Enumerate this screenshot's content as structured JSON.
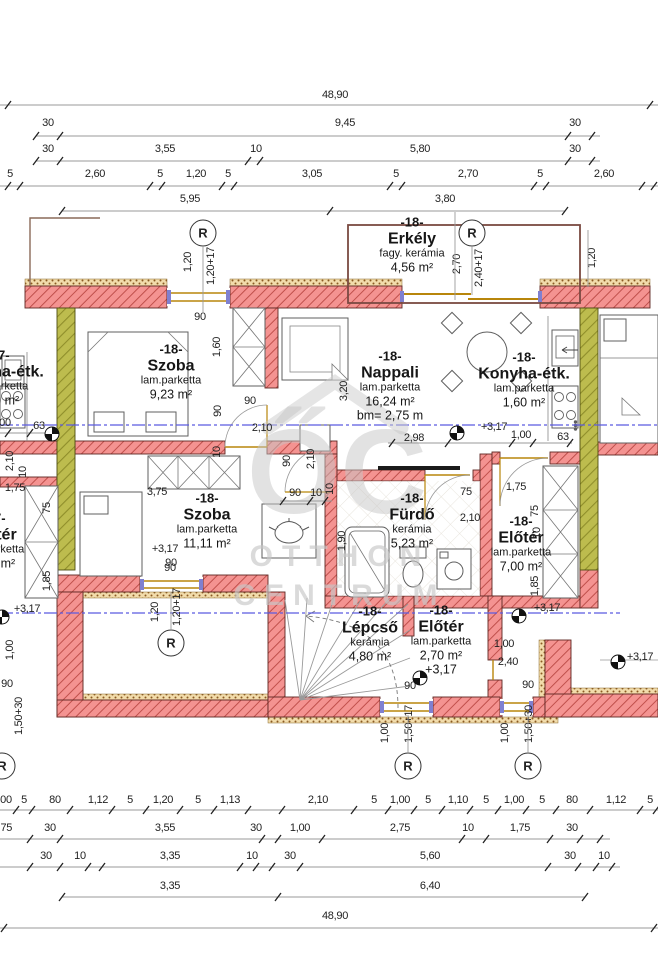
{
  "watermark": {
    "brand_initials": "ŐC",
    "line1": "OTTHON",
    "line2": "CENTRUM"
  },
  "markers": {
    "r_label": "R",
    "r_circles": [
      {
        "x": 203,
        "y": 233
      },
      {
        "x": 472,
        "y": 233
      },
      {
        "x": 171,
        "y": 643
      },
      {
        "x": 408,
        "y": 766
      },
      {
        "x": 528,
        "y": 766
      },
      {
        "x": 2,
        "y": 766
      }
    ],
    "level_markers": [
      {
        "x": 52,
        "y": 434
      },
      {
        "x": 457,
        "y": 433
      },
      {
        "x": 519,
        "y": 616
      },
      {
        "x": 420,
        "y": 678
      },
      {
        "x": 618,
        "y": 662
      },
      {
        "x": 2,
        "y": 617
      }
    ]
  },
  "colors": {
    "wall": "#f49391",
    "wall_hatch": "#c0504c",
    "insulation": "#f2dcab",
    "party_wall": "#bdbc4e",
    "window": "#b8860b",
    "glazing": "#8080d0",
    "section_line": "#5b5be0",
    "watermark": "#c7c7c7"
  },
  "rooms": [
    {
      "x": -2,
      "y": 378,
      "id": "-17-",
      "name": "Konyha-étk.",
      "material": "lam.parketta",
      "area": "1,60 m²"
    },
    {
      "x": 412,
      "y": 245,
      "id": "-18-",
      "name": "Erkély",
      "material": "fagy. kerámia",
      "area": "4,56 m²"
    },
    {
      "x": 171,
      "y": 372,
      "id": "-18-",
      "name": "Szoba",
      "material": "lam.parketta",
      "area": "9,23 m²"
    },
    {
      "x": 390,
      "y": 386,
      "id": "-18-",
      "name": "Nappali",
      "material": "lam.parketta",
      "area": "16,24 m²",
      "extra": "bm= 2,75 m"
    },
    {
      "x": 524,
      "y": 380,
      "id": "-18-",
      "name": "Konyha-étk.",
      "material": "lam.parketta",
      "area": "1,60 m²"
    },
    {
      "x": 207,
      "y": 521,
      "id": "-18-",
      "name": "Szoba",
      "material": "lam.parketta",
      "area": "11,11 m²"
    },
    {
      "x": 412,
      "y": 521,
      "id": "-18-",
      "name": "Fürdő",
      "material": "kerámia",
      "area": "5,23 m²"
    },
    {
      "x": 521,
      "y": 544,
      "id": "-18-",
      "name": "Előtér",
      "material": "lam.parketta",
      "area": "7,00 m²"
    },
    {
      "x": 370,
      "y": 634,
      "id": "-18-",
      "name": "Lépcső",
      "material": "kerámia",
      "area": "4,80 m²"
    },
    {
      "x": 441,
      "y": 640,
      "id": "-18-",
      "name": "Előtér",
      "material": "lam.parketta",
      "area": "2,70 m²",
      "extra": "+3,17"
    },
    {
      "x": -6,
      "y": 541,
      "id": "-17-",
      "name": "Előtér",
      "material": "lam.parketta",
      "area": "7,00 m²"
    }
  ],
  "dims": [
    {
      "t": "48,90",
      "x": 335,
      "y": 95
    },
    {
      "t": "30",
      "x": 48,
      "y": 123
    },
    {
      "t": "9,45",
      "x": 345,
      "y": 123
    },
    {
      "t": "30",
      "x": 575,
      "y": 123
    },
    {
      "t": "30",
      "x": 48,
      "y": 149
    },
    {
      "t": "3,55",
      "x": 165,
      "y": 149
    },
    {
      "t": "10",
      "x": 256,
      "y": 149
    },
    {
      "t": "5,80",
      "x": 420,
      "y": 149
    },
    {
      "t": "30",
      "x": 575,
      "y": 149
    },
    {
      "t": "5",
      "x": 10,
      "y": 174
    },
    {
      "t": "2,60",
      "x": 95,
      "y": 174
    },
    {
      "t": "5",
      "x": 160,
      "y": 174
    },
    {
      "t": "1,20",
      "x": 196,
      "y": 174
    },
    {
      "t": "5",
      "x": 228,
      "y": 174
    },
    {
      "t": "3,05",
      "x": 312,
      "y": 174
    },
    {
      "t": "5",
      "x": 396,
      "y": 174
    },
    {
      "t": "2,70",
      "x": 468,
      "y": 174
    },
    {
      "t": "5",
      "x": 540,
      "y": 174
    },
    {
      "t": "2,60",
      "x": 604,
      "y": 174
    },
    {
      "t": "5,95",
      "x": 190,
      "y": 199
    },
    {
      "t": "3,80",
      "x": 445,
      "y": 199
    },
    {
      "t": "1,20",
      "x": 188,
      "y": 262,
      "v": 1
    },
    {
      "t": "1,20+17",
      "x": 211,
      "y": 266,
      "v": 1
    },
    {
      "t": "90",
      "x": 200,
      "y": 317
    },
    {
      "t": "2,70",
      "x": 457,
      "y": 264,
      "v": 1
    },
    {
      "t": "2,40+17",
      "x": 479,
      "y": 268,
      "v": 1
    },
    {
      "t": "1,20",
      "x": 592,
      "y": 258,
      "v": 1
    },
    {
      "t": "1,60",
      "x": 217,
      "y": 347,
      "v": 1
    },
    {
      "t": "90",
      "x": 218,
      "y": 411,
      "v": 1
    },
    {
      "t": "90",
      "x": 250,
      "y": 401
    },
    {
      "t": "2,10",
      "x": 262,
      "y": 428
    },
    {
      "t": "10",
      "x": 217,
      "y": 452,
      "v": 1
    },
    {
      "t": "3,20",
      "x": 344,
      "y": 391,
      "v": 1
    },
    {
      "t": "2,98",
      "x": 414,
      "y": 438
    },
    {
      "t": "+3,17",
      "x": 494,
      "y": 427
    },
    {
      "t": "1,00",
      "x": 521,
      "y": 435
    },
    {
      "t": "63",
      "x": 563,
      "y": 437
    },
    {
      "t": "00",
      "x": 5,
      "y": 423
    },
    {
      "t": "63",
      "x": 39,
      "y": 426
    },
    {
      "t": "2,10",
      "x": 10,
      "y": 461,
      "v": 1
    },
    {
      "t": "10",
      "x": 23,
      "y": 472,
      "v": 1
    },
    {
      "t": "1,75",
      "x": 15,
      "y": 488
    },
    {
      "t": "75",
      "x": 47,
      "y": 508,
      "v": 1
    },
    {
      "t": "1,85",
      "x": 47,
      "y": 581,
      "v": 1
    },
    {
      "t": "3,75",
      "x": 157,
      "y": 492
    },
    {
      "t": "+3,17",
      "x": 165,
      "y": 549
    },
    {
      "t": "90",
      "x": 171,
      "y": 563
    },
    {
      "t": "90",
      "x": 295,
      "y": 493
    },
    {
      "t": "10",
      "x": 316,
      "y": 493
    },
    {
      "t": "90",
      "x": 287,
      "y": 461,
      "v": 1
    },
    {
      "t": "2,10",
      "x": 311,
      "y": 459,
      "v": 1
    },
    {
      "t": "10",
      "x": 330,
      "y": 489,
      "v": 1
    },
    {
      "t": "1,90",
      "x": 342,
      "y": 541,
      "v": 1
    },
    {
      "t": "75",
      "x": 466,
      "y": 492
    },
    {
      "t": "1,75",
      "x": 516,
      "y": 487
    },
    {
      "t": "2,10",
      "x": 470,
      "y": 518
    },
    {
      "t": "75",
      "x": 535,
      "y": 511,
      "v": 1
    },
    {
      "t": "1,85",
      "x": 535,
      "y": 586,
      "v": 1
    },
    {
      "t": "10",
      "x": 537,
      "y": 533,
      "v": 1
    },
    {
      "t": "1,00",
      "x": 504,
      "y": 644
    },
    {
      "t": "2,40",
      "x": 508,
      "y": 662
    },
    {
      "t": "90",
      "x": 410,
      "y": 686
    },
    {
      "t": "90",
      "x": 528,
      "y": 685
    },
    {
      "t": "90",
      "x": 170,
      "y": 568
    },
    {
      "t": "1,20",
      "x": 155,
      "y": 612,
      "v": 1
    },
    {
      "t": "1,20+17",
      "x": 177,
      "y": 607,
      "v": 1
    },
    {
      "t": "+3,17",
      "x": 27,
      "y": 609
    },
    {
      "t": "1,00",
      "x": 10,
      "y": 650,
      "v": 1
    },
    {
      "t": "90",
      "x": 7,
      "y": 684
    },
    {
      "t": "1,50+30",
      "x": 19,
      "y": 716,
      "v": 1
    },
    {
      "t": "1,00",
      "x": 385,
      "y": 733,
      "v": 1
    },
    {
      "t": "1,50+17",
      "x": 409,
      "y": 724,
      "v": 1
    },
    {
      "t": "1,00",
      "x": 505,
      "y": 733,
      "v": 1
    },
    {
      "t": "1,50+30",
      "x": 529,
      "y": 724,
      "v": 1
    },
    {
      "t": "+3,17",
      "x": 547,
      "y": 608
    },
    {
      "t": "+3,17",
      "x": 640,
      "y": 657
    },
    {
      "t": "00",
      "x": 6,
      "y": 800
    },
    {
      "t": "5",
      "x": 24,
      "y": 800
    },
    {
      "t": "80",
      "x": 55,
      "y": 800
    },
    {
      "t": "1,12",
      "x": 98,
      "y": 800
    },
    {
      "t": "5",
      "x": 130,
      "y": 800
    },
    {
      "t": "1,20",
      "x": 163,
      "y": 800
    },
    {
      "t": "5",
      "x": 198,
      "y": 800
    },
    {
      "t": "1,13",
      "x": 230,
      "y": 800
    },
    {
      "t": "2,10",
      "x": 318,
      "y": 800
    },
    {
      "t": "5",
      "x": 374,
      "y": 800
    },
    {
      "t": "1,00",
      "x": 400,
      "y": 800
    },
    {
      "t": "5",
      "x": 428,
      "y": 800
    },
    {
      "t": "1,10",
      "x": 458,
      "y": 800
    },
    {
      "t": "5",
      "x": 486,
      "y": 800
    },
    {
      "t": "1,00",
      "x": 514,
      "y": 800
    },
    {
      "t": "5",
      "x": 542,
      "y": 800
    },
    {
      "t": "80",
      "x": 572,
      "y": 800
    },
    {
      "t": "1,12",
      "x": 616,
      "y": 800
    },
    {
      "t": "5",
      "x": 650,
      "y": 800
    },
    {
      "t": "1,75",
      "x": 2,
      "y": 828
    },
    {
      "t": "30",
      "x": 50,
      "y": 828
    },
    {
      "t": "3,55",
      "x": 165,
      "y": 828
    },
    {
      "t": "30",
      "x": 256,
      "y": 828
    },
    {
      "t": "1,00",
      "x": 300,
      "y": 828
    },
    {
      "t": "2,75",
      "x": 400,
      "y": 828
    },
    {
      "t": "10",
      "x": 468,
      "y": 828
    },
    {
      "t": "1,75",
      "x": 520,
      "y": 828
    },
    {
      "t": "30",
      "x": 572,
      "y": 828
    },
    {
      "t": "30",
      "x": 46,
      "y": 856
    },
    {
      "t": "10",
      "x": 80,
      "y": 856
    },
    {
      "t": "3,35",
      "x": 170,
      "y": 856
    },
    {
      "t": "10",
      "x": 252,
      "y": 856
    },
    {
      "t": "30",
      "x": 290,
      "y": 856
    },
    {
      "t": "5,60",
      "x": 430,
      "y": 856
    },
    {
      "t": "30",
      "x": 570,
      "y": 856
    },
    {
      "t": "10",
      "x": 604,
      "y": 856
    },
    {
      "t": "3,35",
      "x": 170,
      "y": 886
    },
    {
      "t": "6,40",
      "x": 430,
      "y": 886
    },
    {
      "t": "48,90",
      "x": 335,
      "y": 916
    }
  ]
}
